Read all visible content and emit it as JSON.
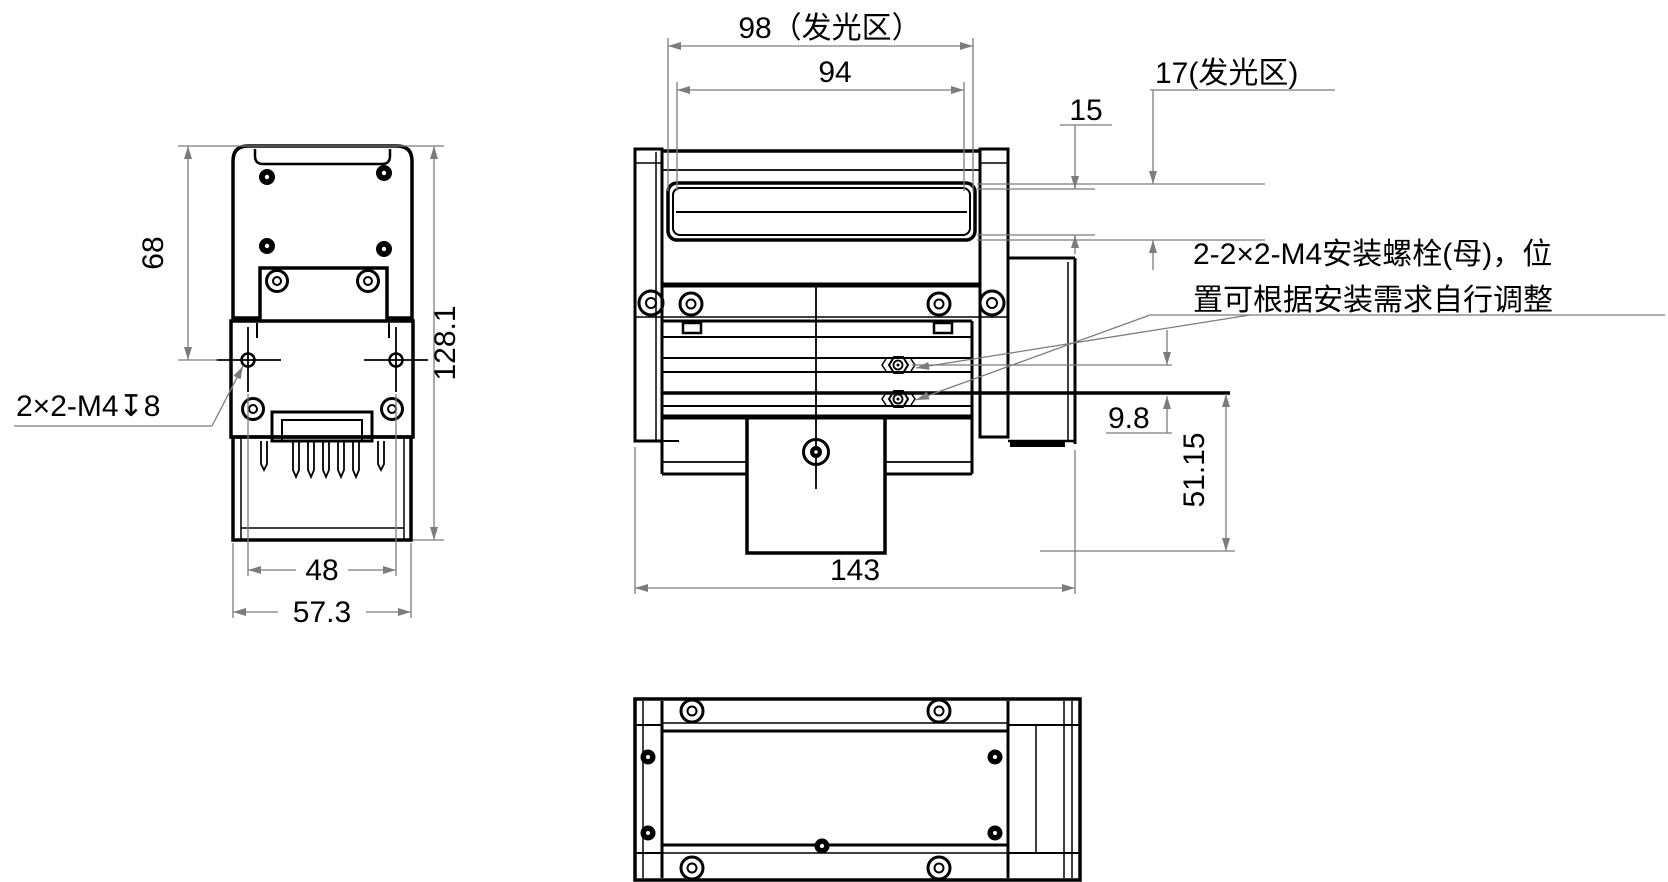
{
  "drawing": {
    "kind": "mechanical-dimension-drawing",
    "colors": {
      "line": "#000000",
      "dimension": "#7c7c7c",
      "background": "#ffffff"
    },
    "dimensions": {
      "side": {
        "upper_height": "68",
        "total_height": "128.1",
        "pin_spacing": "48",
        "total_width": "57.3",
        "thread_callout": "2×2-M4↧8"
      },
      "front": {
        "emitting_width": "98（发光区）",
        "window_width": "94",
        "window_height": "15",
        "emitting_height": "17(发光区)",
        "plate_offset": "9.8",
        "lower_height": "51.15",
        "total_length": "143"
      },
      "note": {
        "line1": "2-2×2-M4安装螺栓(母)，位",
        "line2": "置可根据安装需求自行调整"
      }
    }
  }
}
